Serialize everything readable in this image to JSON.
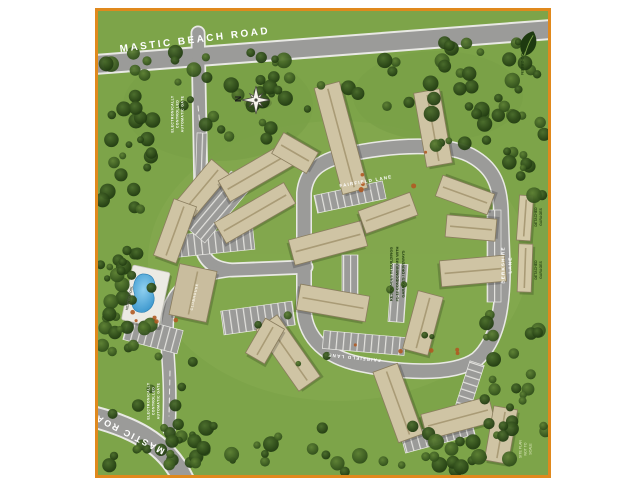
{
  "map": {
    "description": "Aerial site plan of a gated residential community bounded by Mastic Beach Road and Mastic Road, with apartment buildings, clubhouse, heated pool, detached garages and internal lanes",
    "colors": {
      "border": "#e0891d",
      "grass": "#7da449",
      "road": "#9b9b99",
      "building": "#cfc4a4",
      "pool_water": "#3f9fd8"
    },
    "labels": {
      "mastic_beach_road": "MASTIC BEACH ROAD",
      "mastic_road": "MASTIC ROAD",
      "fairfield_lane_top": "FAIRFIELD LANE",
      "fairfield_lane_bottom": "FAIRFIELD LANE",
      "berkshire_lane": "BERKSHIRE LANE",
      "north_gate": "ELECTRONICALLY\nCONTROLLED\nAUTOMATIC GATE",
      "south_gate": "ELECTRONICALLY\nCONTROLLED\nAUTOMATIC GATE",
      "heated_pool": "HEATED POOL",
      "clubhouse": "CLUBHOUSE",
      "garages_north": "DETACHED GARAGES",
      "garages_south": "DETACHED GARAGES",
      "residences_note": "RESIDENCES IN BUILDINGS\n#1-12 CONDOMINIUMS WITH\nGARAGES / DRIVEWAYS",
      "compass_north": "N",
      "logo": "GO GREEN",
      "disclaimer": "SITE PLAN NOT TO SCALE"
    }
  }
}
